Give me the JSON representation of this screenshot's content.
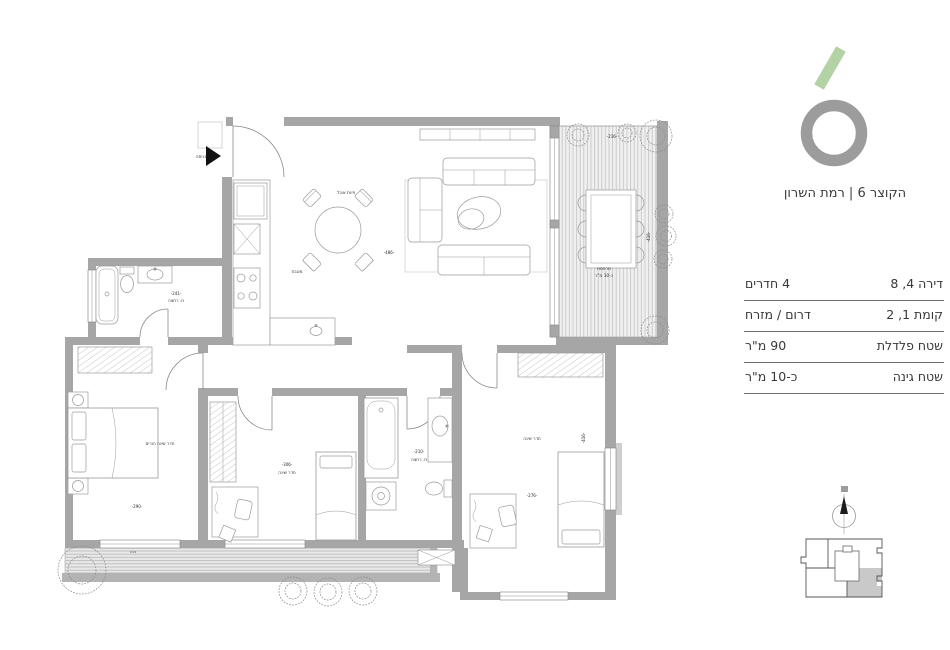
{
  "brand": {
    "project_name": "הקוצר 6 | רמת השרון",
    "logo_accent_color": "#b3d2a6",
    "logo_ring_color": "#9c9c9c"
  },
  "specs": {
    "rows": [
      {
        "label": "דירה 4‏, 8",
        "value": "4 חדרים"
      },
      {
        "label": "קומת 1‏, 2",
        "value": "דרום / מזרח"
      },
      {
        "label": "שטח פלדלת",
        "value": "90 מ\"ר"
      },
      {
        "label": "שטח גינה",
        "value": "כ-10 מ\"ר"
      }
    ]
  },
  "floorplan": {
    "entrance_label": "כניסה",
    "labels": {
      "dining": "פינת אוכל",
      "kitchen": "מטבח",
      "living_dim": "-486-",
      "balcony_name": "מרפסת",
      "balcony_area": "כ-10 מ\"ר",
      "balcony_dim": "-216-",
      "balcony_dim_v": "-416-",
      "master_name": "חדר שינה הורים",
      "master_dim": "-290-",
      "master_bath_name": "ח. רחצה",
      "master_bath_dim": "-241-",
      "bedroom_a_name": "חדר שינה",
      "bedroom_a_dim": "-306-",
      "bath_name": "ח. רחצה",
      "bath_dim": "-210-",
      "bedroom_b_name": "חדר שינה",
      "bedroom_b_dim": "-276-",
      "bedroom_b_dim_v": "-416-",
      "garden_name": "גינה"
    }
  }
}
